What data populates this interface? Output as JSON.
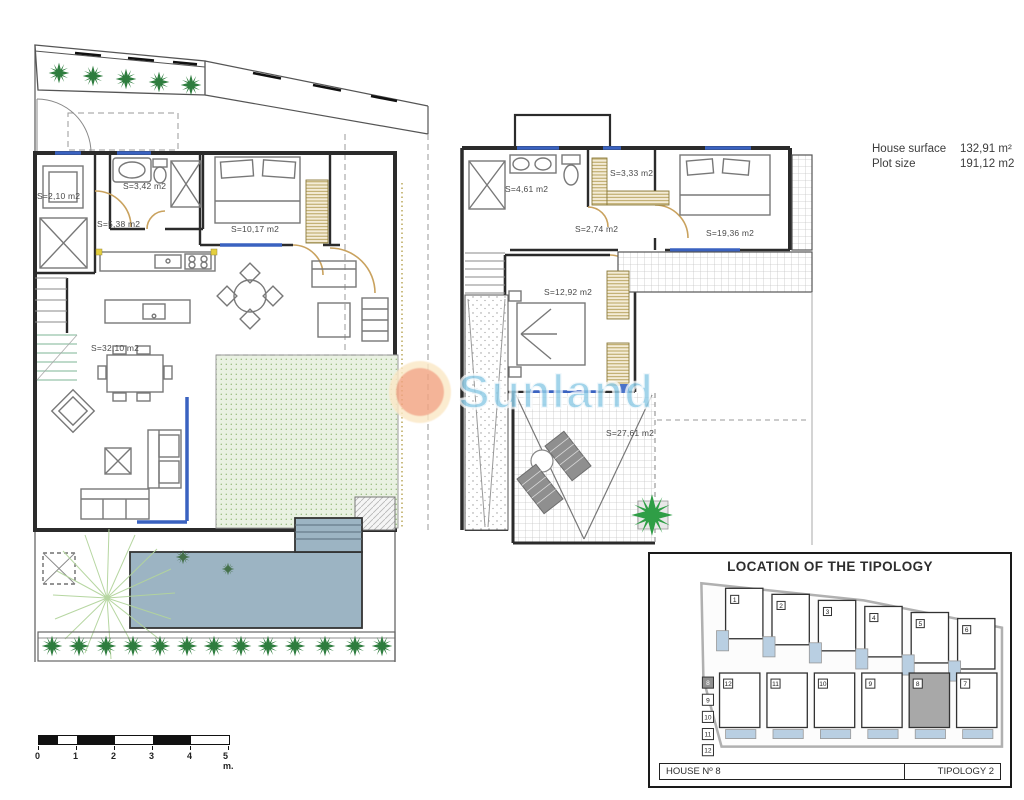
{
  "info": {
    "rows": [
      {
        "label": "House surface",
        "value": "132,91 m²"
      },
      {
        "label": "Plot size",
        "value": "191,12 m2"
      }
    ]
  },
  "watermark": {
    "text": "Sunland"
  },
  "plans": {
    "ground_floor": {
      "rooms": [
        {
          "name": "storage",
          "area": "S=2,10 m2"
        },
        {
          "name": "bathroom",
          "area": "S=3,42 m2"
        },
        {
          "name": "hallway",
          "area": "S=5,38 m2"
        },
        {
          "name": "bedroom",
          "area": "S=10,17 m2"
        },
        {
          "name": "living-kitchen",
          "area": "S=32,10 m2"
        }
      ]
    },
    "first_floor": {
      "rooms": [
        {
          "name": "bathroom",
          "area": "S=4,61 m2"
        },
        {
          "name": "wardrobe",
          "area": "S=3,33 m2"
        },
        {
          "name": "landing",
          "area": "S=2,74 m2"
        },
        {
          "name": "bedroom-main",
          "area": "S=19,36 m2"
        },
        {
          "name": "bedroom-2",
          "area": "S=12,92 m2"
        },
        {
          "name": "terrace",
          "area": "S=27,61 m2"
        }
      ]
    }
  },
  "location": {
    "title": "LOCATION OF THE TIPOLOGY",
    "house_label": "HOUSE Nº 8",
    "tipology_label": "TIPOLOGY 2",
    "top_units": [
      "1",
      "2",
      "3",
      "4",
      "5",
      "6"
    ],
    "bottom_units": [
      "12",
      "11",
      "10",
      "9",
      "8",
      "7"
    ],
    "side_units": [
      "8",
      "9",
      "10",
      "11",
      "12"
    ],
    "highlighted_unit": "8"
  },
  "scale_bar": {
    "labels": [
      "0",
      "1",
      "2",
      "3",
      "4"
    ],
    "end_label": "5 m."
  },
  "colors": {
    "wall": "#2b2b2b",
    "window_blue": "#3a62c0",
    "door_tan": "#c9a25e",
    "plant_green": "#2e7d3e",
    "palm_green": "#2f9e46",
    "pool_blue": "#9cb4c3",
    "site_pool_blue": "#b9cfe2",
    "highlight_gray": "#a8a8a8",
    "watermark_blue": "#8ecbe6",
    "watermark_orange": "#f2a482"
  }
}
